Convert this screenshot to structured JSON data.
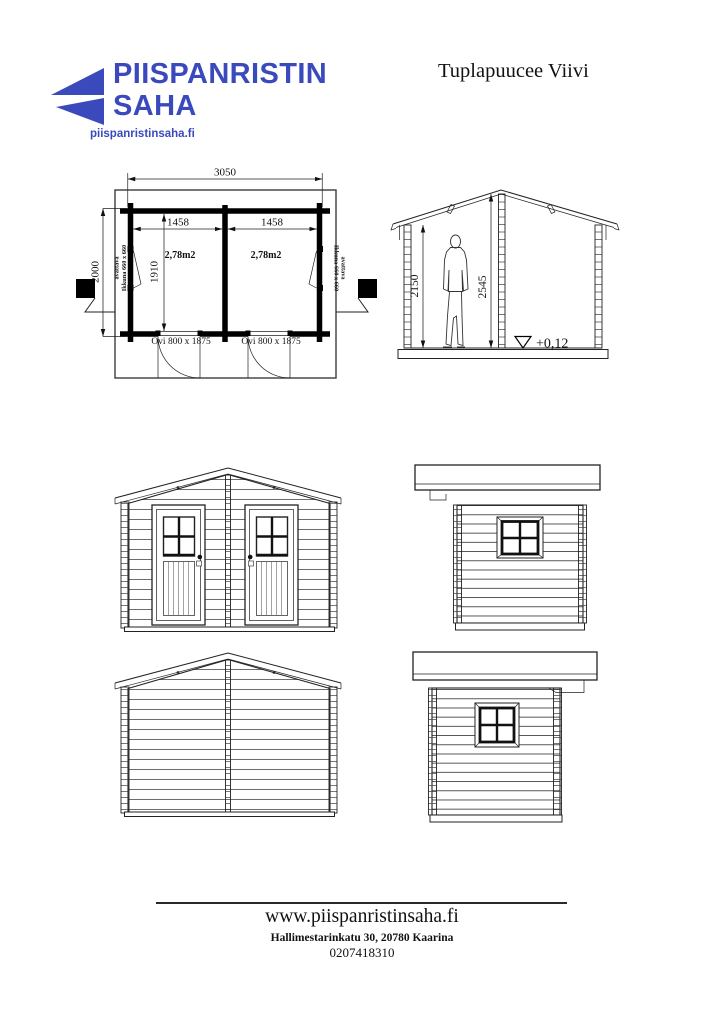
{
  "header": {
    "logo_line1": "PIISPANRISTIN",
    "logo_line2": "SAHA",
    "logo_url": "piispanristinsaha.fi",
    "title": "Tuplapuucee Viivi",
    "brand_color": "#3a4abc"
  },
  "floor_plan": {
    "dim_total_width": "3050",
    "dim_room_left": "1458",
    "dim_room_right": "1458",
    "dim_total_depth": "2000",
    "dim_inner_depth": "1910",
    "area_left": "2,78m2",
    "area_right": "2,78m2",
    "door_left_label": "Ovi 800 x 1875",
    "door_right_label": "Ovi 800 x 1875",
    "window_left_line1": "Ikkuna 660 x 660",
    "window_left_line2": "avattava",
    "window_right_line1": "Ikkuna 660 x 660",
    "window_right_line2": "avattava"
  },
  "section": {
    "dim_wall_height": "2150",
    "dim_ridge_height": "2545",
    "floor_level": "+0,12"
  },
  "footer": {
    "website": "www.piispanristinsaha.fi",
    "address": "Hallimestarinkatu 30, 20780 Kaarina",
    "phone": "0207418310"
  }
}
